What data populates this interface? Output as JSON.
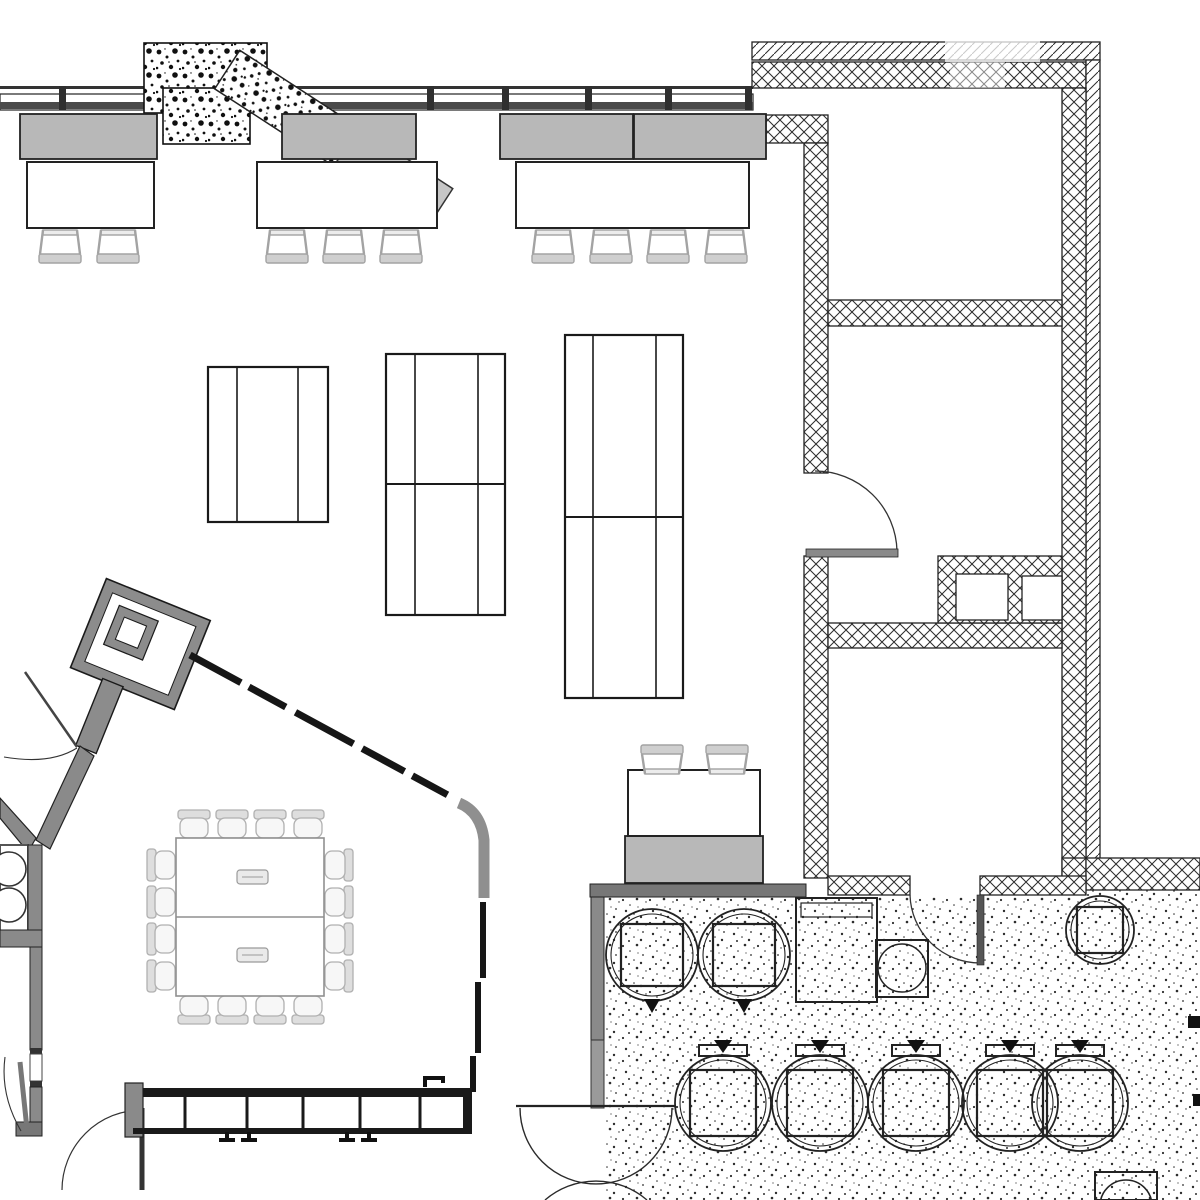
{
  "title": "architectural-floor-plan",
  "palette": {
    "background": "#ffffff",
    "line_black": "#1a1a1a",
    "hatch_line": "#2e2e2e",
    "wall_gray": "#8a8a8a",
    "wall_dark": "#4a4a4a",
    "cabinet_gray": "#b8b8b8",
    "glazing_gray": "#c6c6c6",
    "chair_light_gray": "#a3a3a3",
    "conference_gray": "#b0b0b0",
    "stipple_dot": "#2d2d2d",
    "speckle_dot": "#101010"
  },
  "window_wall": {
    "ticks_x": [
      62,
      268,
      430,
      505,
      588,
      668,
      748
    ],
    "band": [
      0,
      86,
      753,
      24
    ]
  },
  "speckle_boxes": [
    [
      144,
      43,
      123,
      70
    ],
    [
      163,
      88,
      87,
      56
    ]
  ],
  "furniture": {
    "top_desks": [
      {
        "cabinets": [
          [
            20,
            114,
            137,
            45
          ]
        ],
        "table": [
          27,
          162,
          127,
          66
        ],
        "chairs_x": [
          60,
          118
        ],
        "chairs_y": 230,
        "flip": false
      },
      {
        "cabinets": [
          [
            282,
            114,
            134,
            45
          ]
        ],
        "table": [
          257,
          162,
          180,
          66
        ],
        "chairs_x": [
          287,
          344,
          401
        ],
        "chairs_y": 230,
        "flip": false
      },
      {
        "cabinets": [
          [
            500,
            114,
            133,
            45
          ],
          [
            634,
            114,
            132,
            45
          ]
        ],
        "table": [
          516,
          162,
          233,
          66
        ],
        "chairs_x": [
          553,
          611,
          668,
          726
        ],
        "chairs_y": 230,
        "flip": false
      }
    ],
    "hall_desk": {
      "cabinets": [
        [
          625,
          836,
          138,
          47
        ]
      ],
      "table": [
        628,
        770,
        132,
        66
      ],
      "chairs_x": [
        662,
        727
      ],
      "chairs_y": 745,
      "flip": true
    },
    "work_tables": [
      {
        "rect": [
          208,
          367,
          120,
          155
        ],
        "v_lines": [
          237,
          298
        ],
        "h_lines": []
      },
      {
        "rect": [
          386,
          354,
          119,
          261
        ],
        "v_lines": [
          415,
          478
        ],
        "h_lines": [
          484
        ]
      },
      {
        "rect": [
          565,
          335,
          118,
          363
        ],
        "v_lines": [
          593,
          656
        ],
        "h_lines": [
          517
        ]
      }
    ],
    "conference": {
      "table": [
        176,
        838,
        148,
        158
      ],
      "divider_y": 917,
      "grommets": [
        [
          237,
          870
        ],
        [
          237,
          948
        ]
      ],
      "grommet_size": [
        31,
        14
      ],
      "chairs_top_x": [
        194,
        232,
        270,
        308
      ],
      "top_cy": 824,
      "chairs_bottom_x": [
        194,
        232,
        270,
        308
      ],
      "bottom_cy": 1010,
      "chairs_left_y": [
        865,
        902,
        939,
        976
      ],
      "left_cx": 161,
      "chairs_right_y": [
        865,
        902,
        939,
        976
      ],
      "right_cx": 339
    },
    "salon_chairs": [
      {
        "cx": 652,
        "cy": 955,
        "r": 46,
        "mark": "bottom"
      },
      {
        "cx": 744,
        "cy": 955,
        "r": 46,
        "mark": "bottom"
      },
      {
        "cx": 723,
        "cy": 1103,
        "r": 48,
        "mark": "top"
      },
      {
        "cx": 820,
        "cy": 1103,
        "r": 48,
        "mark": "top"
      },
      {
        "cx": 916,
        "cy": 1103,
        "r": 48,
        "mark": "top"
      },
      {
        "cx": 1010,
        "cy": 1103,
        "r": 48,
        "mark": "top"
      },
      {
        "cx": 1080,
        "cy": 1103,
        "r": 48,
        "mark": "top"
      },
      {
        "cx": 1100,
        "cy": 930,
        "r": 34,
        "mark": "plain"
      }
    ],
    "appliances": {
      "dishwasher": [
        796,
        898,
        81,
        104
      ],
      "dishwasher_inner": [
        801,
        903,
        71,
        14
      ],
      "sink_unit": [
        876,
        940,
        52,
        57
      ],
      "sink_circle": [
        902,
        968,
        24
      ],
      "corner_unit": [
        1095,
        1172,
        62,
        28
      ],
      "corner_circle": [
        1126,
        1206,
        26
      ],
      "stove_circles": [
        [
          9,
          869,
          17
        ],
        [
          9,
          905,
          17
        ]
      ],
      "edge_marks": [
        [
          1188,
          1016,
          12,
          12
        ],
        [
          1193,
          1094,
          7,
          12
        ]
      ]
    },
    "bench": {
      "rail": [
        143,
        1088,
        327,
        9
      ],
      "bottom_rail": [
        133,
        1128,
        338,
        6
      ],
      "dividers_x": [
        185,
        247,
        303,
        360,
        420
      ],
      "divider_y": [
        1097,
        1128
      ],
      "left_post": [
        125,
        1083,
        18,
        54
      ],
      "right_cap": [
        463,
        1088,
        9,
        46
      ],
      "feet_x": [
        227,
        249,
        347,
        369
      ],
      "feet_y": 1132,
      "hook": [
        425,
        1078
      ]
    }
  },
  "counts": {
    "top_desk_chairs": 9,
    "conference_chairs": 16,
    "salon_chairs": 8,
    "work_tables": 3,
    "rooms_right_wing": 3
  }
}
